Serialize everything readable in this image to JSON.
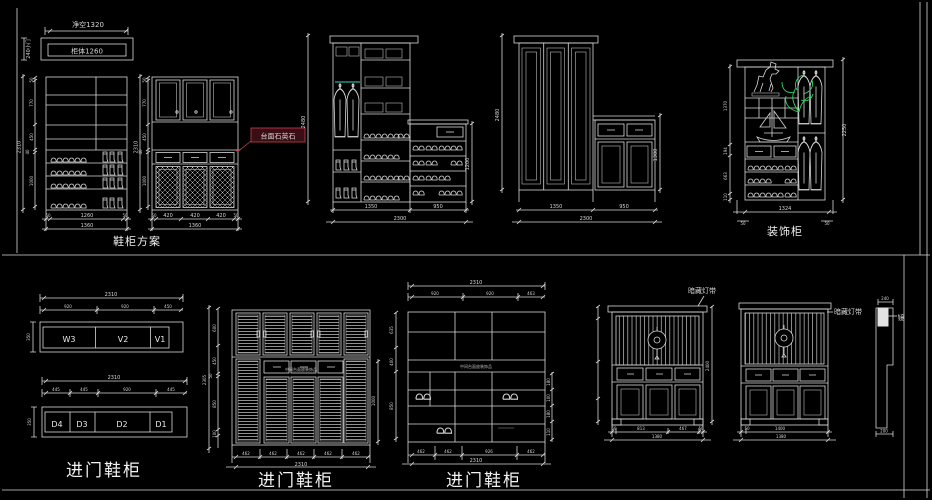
{
  "header": {
    "clear": "净空1320",
    "carcass": "柜体1260",
    "side": "240小门"
  },
  "shoe_plan": {
    "label": "鞋柜方案",
    "total_h": "2310",
    "segs": [
      "50",
      "770",
      "450",
      "40",
      "1000"
    ],
    "a_bottom": [
      "50",
      "1260",
      "50"
    ],
    "a_total": "1360",
    "b_bottom": [
      "50",
      "420",
      "420",
      "420",
      "50"
    ],
    "b_total": "1360",
    "red_note": "台面石英石"
  },
  "wardrobe": {
    "c_height": "2480",
    "c_bench": "1200",
    "c_w1": "1350",
    "c_w2": "950",
    "c_total": "2300",
    "d_height": "2480",
    "d_bench": "1300",
    "d_w1": "1350",
    "d_w2": "950",
    "d_total": "2300"
  },
  "deco": {
    "label": "装饰柜",
    "segs": [
      "1370",
      "194",
      "663",
      "110"
    ],
    "height": "2250",
    "width": "1324",
    "bottom_left": "50",
    "bottom_right": "50"
  },
  "strips": {
    "label": "进门鞋柜",
    "s1_total": "2310",
    "s1_segs": [
      "920",
      "920",
      "450"
    ],
    "s1_cells": [
      "W3",
      "V2",
      "V1"
    ],
    "s1_depth": "350",
    "s2_total": "2310",
    "s2_segs": [
      "445",
      "445",
      "920",
      "445"
    ],
    "s2_cells": [
      "D4",
      "D3",
      "D2",
      "D1"
    ],
    "s2_depth": "350"
  },
  "louver": {
    "label": "进门鞋柜",
    "note": "中间台面放装饰品",
    "left_total": "2305",
    "left_segs": [
      "600",
      "450",
      "50",
      "850",
      "100"
    ],
    "right": "1000",
    "bottom_segs": [
      "462",
      "462",
      "462",
      "462",
      "462"
    ],
    "bottom_total": "2310"
  },
  "frame": {
    "label": "进门鞋柜",
    "note": "中间台面放装饰品",
    "top_total": "2310",
    "top_segs": [
      "920",
      "920",
      "463"
    ],
    "left_segs": [
      "635",
      "400",
      "850"
    ],
    "right_segs": [
      "180",
      "100",
      "180",
      "110"
    ],
    "bottom_segs": [
      "462",
      "462",
      "926",
      "462"
    ],
    "bottom_total": "2310"
  },
  "chinese": {
    "light1": "暗藏灯带",
    "light2": "暗藏灯带",
    "c1_height": "2400",
    "c1_bottom": [
      "50",
      "813",
      "467",
      "50"
    ],
    "c1_total": "1380",
    "c2_bottom": [
      "50",
      "1400"
    ],
    "c2_total": "1380"
  },
  "section": {
    "top": "240",
    "bottom": "200",
    "label": "镜"
  }
}
